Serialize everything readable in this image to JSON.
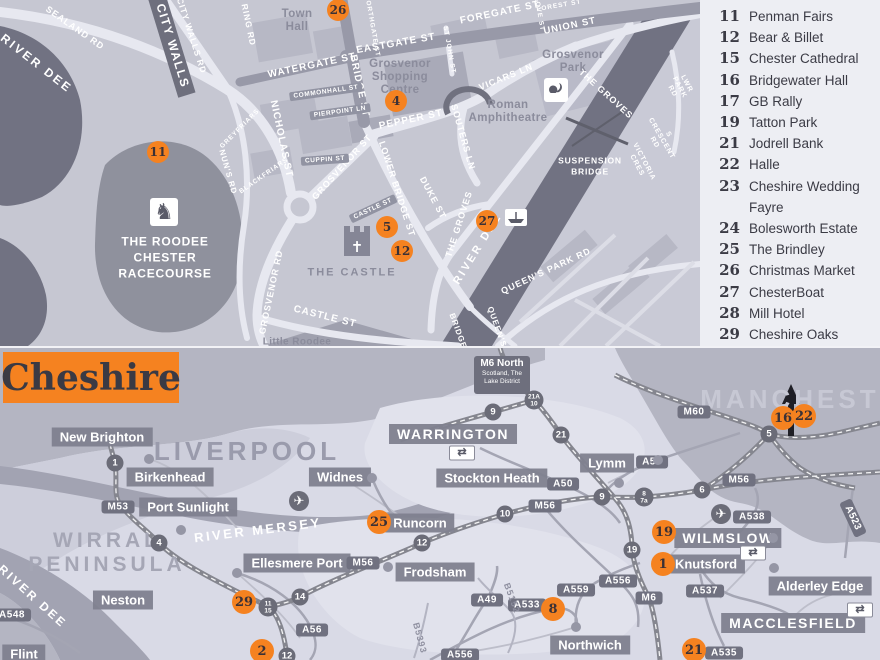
{
  "colors": {
    "orange": "#f58220",
    "map_bg": "#c6c7d2",
    "river": "#717282",
    "legend_bg": "#edeef3",
    "urban_gray": "#b4b5c2",
    "water_gray": "#a2a3b2",
    "dark_text": "#3b3b45"
  },
  "legend": {
    "items": [
      {
        "num": "11",
        "label": "Penman Fairs"
      },
      {
        "num": "12",
        "label": "Bear & Billet"
      },
      {
        "num": "15",
        "label": "Chester Cathedral"
      },
      {
        "num": "16",
        "label": "Bridgewater Hall"
      },
      {
        "num": "17",
        "label": "GB Rally"
      },
      {
        "num": "19",
        "label": "Tatton Park"
      },
      {
        "num": "21",
        "label": "Jodrell Bank"
      },
      {
        "num": "22",
        "label": "Halle"
      },
      {
        "num": "23",
        "label": "Cheshire Wedding\nFayre"
      },
      {
        "num": "24",
        "label": "Bolesworth Estate"
      },
      {
        "num": "25",
        "label": "The Brindley"
      },
      {
        "num": "26",
        "label": "Christmas Market"
      },
      {
        "num": "27",
        "label": "ChesterBoat"
      },
      {
        "num": "28",
        "label": "Mill Hotel"
      },
      {
        "num": "29",
        "label": "Cheshire Oaks"
      }
    ]
  },
  "city_map": {
    "street_labels": [
      {
        "t": "SEALAND RD",
        "x": 75,
        "y": 28,
        "r": 35,
        "s": 9
      },
      {
        "t": "CITY WALLS RD",
        "x": 191,
        "y": 36,
        "r": 72,
        "s": 8.5
      },
      {
        "t": "RING RD",
        "x": 248,
        "y": 25,
        "r": 78,
        "s": 8.5
      },
      {
        "t": "NORTHGATE ST",
        "x": 372,
        "y": 26,
        "r": 80,
        "s": 6.5
      },
      {
        "t": "EASTGATE ST",
        "x": 396,
        "y": 44,
        "r": -10,
        "s": 10
      },
      {
        "t": "FOREGATE ST",
        "x": 500,
        "y": 13,
        "r": -12,
        "s": 10
      },
      {
        "t": "WATERGATE ST",
        "x": 312,
        "y": 66,
        "r": -12,
        "s": 10
      },
      {
        "t": "BRIDGE ST",
        "x": 359,
        "y": 86,
        "r": 78,
        "s": 10
      },
      {
        "t": "UNION ST",
        "x": 570,
        "y": 27,
        "r": -12,
        "s": 9.5
      },
      {
        "t": "FOREST ST",
        "x": 559,
        "y": 6,
        "r": -10,
        "s": 6.5
      },
      {
        "t": "LOVE ST",
        "x": 539,
        "y": 14,
        "r": 80,
        "s": 6.5
      },
      {
        "t": "ST JOHN ST",
        "x": 449,
        "y": 50,
        "r": 80,
        "s": 6.5
      },
      {
        "t": "VICARS LN",
        "x": 506,
        "y": 77,
        "r": -22,
        "s": 9
      },
      {
        "t": "SOUTERS LN",
        "x": 463,
        "y": 137,
        "r": 74,
        "s": 9
      },
      {
        "t": "PEPPER ST",
        "x": 411,
        "y": 120,
        "r": -12,
        "s": 10
      },
      {
        "t": "NICHOLAS ST",
        "x": 281,
        "y": 139,
        "r": 78,
        "s": 10
      },
      {
        "t": "GREYFRIARS",
        "x": 240,
        "y": 129,
        "r": -45,
        "s": 6.5
      },
      {
        "t": "BLACKFRIARS",
        "x": 264,
        "y": 176,
        "r": -35,
        "s": 6.5
      },
      {
        "t": "GROSVENOR ST",
        "x": 342,
        "y": 167,
        "r": -48,
        "s": 9
      },
      {
        "t": "LOWER BRIDGE ST",
        "x": 397,
        "y": 189,
        "r": 72,
        "s": 9
      },
      {
        "t": "DUKE ST",
        "x": 433,
        "y": 198,
        "r": 62,
        "s": 9
      },
      {
        "t": "NUN'S RD",
        "x": 228,
        "y": 172,
        "r": 74,
        "s": 8
      },
      {
        "t": "GROSVENOR RD",
        "x": 271,
        "y": 292,
        "r": -78,
        "s": 9
      },
      {
        "t": "CASTLE ST",
        "x": 325,
        "y": 317,
        "r": 14,
        "s": 10
      },
      {
        "t": "THE GROVES",
        "x": 606,
        "y": 94,
        "r": 42,
        "s": 9
      },
      {
        "t": "THE GROVES",
        "x": 459,
        "y": 224,
        "r": -72,
        "s": 9
      },
      {
        "t": "QUEEN'S PARK RD",
        "x": 546,
        "y": 271,
        "r": -25,
        "s": 9
      },
      {
        "t": "QUEEN'S",
        "x": 497,
        "y": 327,
        "r": 70,
        "s": 8
      },
      {
        "t": "BRIDGE",
        "x": 458,
        "y": 331,
        "r": 70,
        "s": 8
      },
      {
        "t": "VICTORIA CRES",
        "x": 640,
        "y": 164,
        "r": 62,
        "s": 7
      },
      {
        "t": "S CRESCENT RD",
        "x": 661,
        "y": 139,
        "r": 60,
        "s": 7
      },
      {
        "t": "LWR PARK RD",
        "x": 679,
        "y": 88,
        "r": 62,
        "s": 7
      }
    ],
    "river_labels": [
      {
        "t": "RIVER DEE",
        "x": 36,
        "y": 64,
        "r": 38,
        "s": 12
      },
      {
        "t": "RIVER DEE",
        "x": 478,
        "y": 249,
        "r": -58,
        "s": 11
      }
    ],
    "area_labels": [
      {
        "t": "Town\nHall",
        "x": 297,
        "y": 21,
        "s": 11.5
      },
      {
        "t": "Grosvenor\nShopping\nCentre",
        "x": 400,
        "y": 78,
        "s": 11.5
      },
      {
        "t": "Grosvenor\nPark",
        "x": 573,
        "y": 62,
        "s": 11.5
      },
      {
        "t": "Roman\nAmphitheatre",
        "x": 508,
        "y": 112,
        "s": 11.5
      },
      {
        "t": "THE CASTLE",
        "x": 352,
        "y": 273,
        "s": 11,
        "caps": true
      },
      {
        "t": "Little Roodee",
        "x": 297,
        "y": 342,
        "s": 10
      }
    ],
    "white_big": [
      {
        "t": "THE ROODEE\nCHESTER\nRACECOURSE",
        "x": 165,
        "y": 258,
        "s": 12
      },
      {
        "t": "SUSPENSION\nBRIDGE",
        "x": 590,
        "y": 167,
        "s": 8.5
      }
    ],
    "pills": [
      {
        "t": "CASTLE ST",
        "x": 373,
        "y": 209,
        "r": -25
      },
      {
        "t": "COMMONHALL ST",
        "x": 326,
        "y": 92,
        "r": -8
      },
      {
        "t": "PIERPOINT LN",
        "x": 340,
        "y": 112,
        "r": -8
      },
      {
        "t": "CUPPIN ST",
        "x": 325,
        "y": 160,
        "r": -4
      }
    ],
    "dark_pill": {
      "t": "CITY WALLS",
      "x": 172,
      "y": 46,
      "r": 73
    },
    "markers": [
      {
        "n": "26",
        "x": 338,
        "y": 10
      },
      {
        "n": "4",
        "x": 396,
        "y": 101
      },
      {
        "n": "11",
        "x": 158,
        "y": 152
      },
      {
        "n": "5",
        "x": 387,
        "y": 227
      },
      {
        "n": "12",
        "x": 402,
        "y": 251
      },
      {
        "n": "27",
        "x": 487,
        "y": 221
      }
    ],
    "icons": [
      {
        "name": "racehorse-icon",
        "x": 164,
        "y": 212
      },
      {
        "name": "squirrel-icon",
        "x": 556,
        "y": 90
      }
    ]
  },
  "regional_map": {
    "title": "Cheshire",
    "sign": {
      "line1": "M6 North",
      "line2": "Scotland, The",
      "line3": "Lake District"
    },
    "city_labels": [
      {
        "t": "LIVERPOOL",
        "x": 247,
        "y": 104,
        "s": 26,
        "c": "#9a9bac"
      },
      {
        "t": "MANCHESTER",
        "x": 812,
        "y": 52,
        "s": 26,
        "c": "#c7c8d4"
      },
      {
        "t": "WIRRAL\nPENINSULA",
        "x": 107,
        "y": 205,
        "s": 21,
        "c": "#a5a6b5"
      }
    ],
    "river_labels": [
      {
        "t": "RIVER MERSEY",
        "x": 258,
        "y": 183,
        "r": -7,
        "s": 13
      },
      {
        "t": "RIVER DEE",
        "x": 32,
        "y": 249,
        "r": 42,
        "s": 12
      }
    ],
    "towns": [
      {
        "t": "New Brighton",
        "x": 102,
        "y": 89
      },
      {
        "t": "Birkenhead",
        "x": 170,
        "y": 129
      },
      {
        "t": "Port Sunlight",
        "x": 188,
        "y": 159
      },
      {
        "t": "Widnes",
        "x": 340,
        "y": 129
      },
      {
        "t": "WARRINGTON",
        "x": 453,
        "y": 86,
        "big": true
      },
      {
        "t": "Stockton Heath",
        "x": 492,
        "y": 130
      },
      {
        "t": "Runcorn",
        "x": 420,
        "y": 175
      },
      {
        "t": "Lymm",
        "x": 607,
        "y": 115
      },
      {
        "t": "Ellesmere Port",
        "x": 297,
        "y": 215
      },
      {
        "t": "Neston",
        "x": 123,
        "y": 252
      },
      {
        "t": "Flint",
        "x": 24,
        "y": 306
      },
      {
        "t": "Frodsham",
        "x": 435,
        "y": 224
      },
      {
        "t": "Northwich",
        "x": 590,
        "y": 297
      },
      {
        "t": "Knutsford",
        "x": 706,
        "y": 216
      },
      {
        "t": "WILMSLOW",
        "x": 728,
        "y": 190,
        "big": true
      },
      {
        "t": "Alderley Edge",
        "x": 820,
        "y": 238
      },
      {
        "t": "MACCLESFIELD",
        "x": 793,
        "y": 275,
        "big": true
      }
    ],
    "shields": [
      {
        "t": "M53",
        "x": 118,
        "y": 159
      },
      {
        "t": "M56",
        "x": 363,
        "y": 215
      },
      {
        "t": "M56",
        "x": 545,
        "y": 158
      },
      {
        "t": "M56",
        "x": 739,
        "y": 132
      },
      {
        "t": "M60",
        "x": 694,
        "y": 64
      },
      {
        "t": "M6",
        "x": 649,
        "y": 250
      },
      {
        "t": "A56",
        "x": 652,
        "y": 114
      },
      {
        "t": "A56",
        "x": 312,
        "y": 282
      },
      {
        "t": "A50",
        "x": 563,
        "y": 136
      },
      {
        "t": "A538",
        "x": 752,
        "y": 169
      },
      {
        "t": "A523",
        "x": 853,
        "y": 170,
        "r": 65
      },
      {
        "t": "A556",
        "x": 618,
        "y": 233
      },
      {
        "t": "A556",
        "x": 460,
        "y": 307
      },
      {
        "t": "A559",
        "x": 576,
        "y": 242
      },
      {
        "t": "A533",
        "x": 527,
        "y": 257
      },
      {
        "t": "A49",
        "x": 487,
        "y": 252
      },
      {
        "t": "A537",
        "x": 705,
        "y": 243
      },
      {
        "t": "A535",
        "x": 724,
        "y": 305
      },
      {
        "t": "A548",
        "x": 12,
        "y": 267
      }
    ],
    "b_roads": [
      {
        "t": "B5393",
        "x": 420,
        "y": 290,
        "r": 75
      },
      {
        "t": "B5152",
        "x": 512,
        "y": 250,
        "r": 70
      }
    ],
    "junctions": [
      {
        "t": "1",
        "x": 115,
        "y": 115
      },
      {
        "t": "4",
        "x": 159,
        "y": 195
      },
      {
        "t": "14",
        "x": 300,
        "y": 249
      },
      {
        "t": "11|15",
        "x": 268,
        "y": 259
      },
      {
        "t": "12",
        "x": 287,
        "y": 308
      },
      {
        "t": "12",
        "x": 422,
        "y": 195
      },
      {
        "t": "10",
        "x": 505,
        "y": 166
      },
      {
        "t": "9",
        "x": 602,
        "y": 149
      },
      {
        "t": "8|7a",
        "x": 644,
        "y": 149
      },
      {
        "t": "6",
        "x": 702,
        "y": 142
      },
      {
        "t": "5",
        "x": 769,
        "y": 86
      },
      {
        "t": "21",
        "x": 561,
        "y": 87
      },
      {
        "t": "21A|10",
        "x": 534,
        "y": 52
      },
      {
        "t": "9",
        "x": 493,
        "y": 64
      },
      {
        "t": "19",
        "x": 632,
        "y": 202
      }
    ],
    "markers": [
      {
        "n": "25",
        "x": 379,
        "y": 174
      },
      {
        "n": "29",
        "x": 244,
        "y": 254
      },
      {
        "n": "2",
        "x": 262,
        "y": 303
      },
      {
        "n": "8",
        "x": 553,
        "y": 261
      },
      {
        "n": "19",
        "x": 664,
        "y": 184
      },
      {
        "n": "1",
        "x": 663,
        "y": 216
      },
      {
        "n": "21",
        "x": 694,
        "y": 302
      },
      {
        "n": "16",
        "x": 783,
        "y": 70
      },
      {
        "n": "22",
        "x": 804,
        "y": 68
      }
    ],
    "dots": [
      {
        "x": 149,
        "y": 111
      },
      {
        "x": 181,
        "y": 182
      },
      {
        "x": 372,
        "y": 130
      },
      {
        "x": 619,
        "y": 135
      },
      {
        "x": 658,
        "y": 112
      },
      {
        "x": 773,
        "y": 190
      },
      {
        "x": 774,
        "y": 220
      },
      {
        "x": 576,
        "y": 279
      },
      {
        "x": 388,
        "y": 219
      },
      {
        "x": 237,
        "y": 225
      }
    ],
    "rail_icons": [
      {
        "x": 462,
        "y": 105
      },
      {
        "x": 753,
        "y": 205
      },
      {
        "x": 860,
        "y": 262
      }
    ],
    "airport_icons": [
      {
        "x": 299,
        "y": 153
      },
      {
        "x": 721,
        "y": 166
      }
    ]
  }
}
